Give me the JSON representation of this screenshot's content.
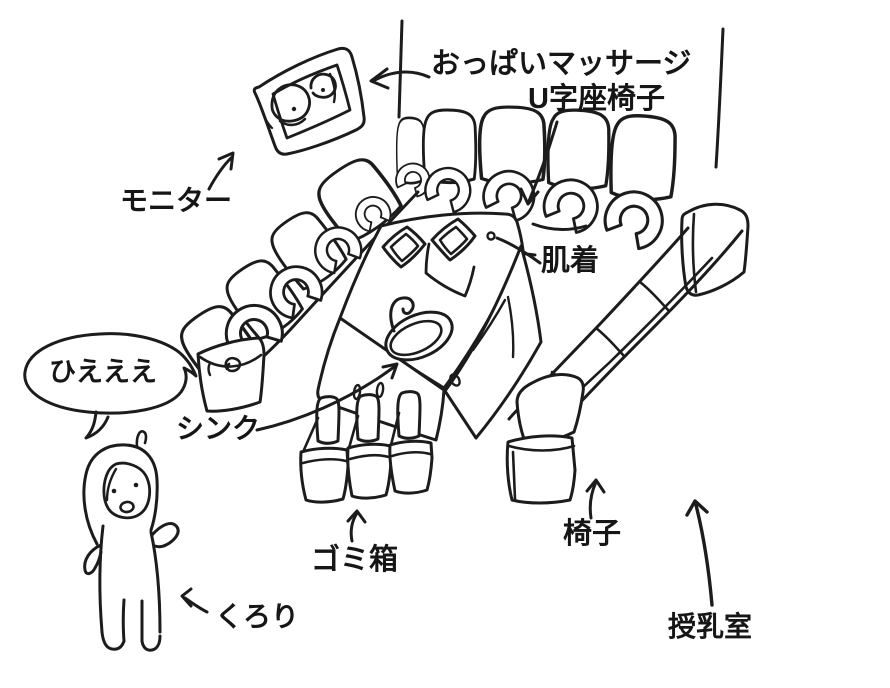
{
  "scene": {
    "labels": {
      "massage": "おっぱいマッサージ",
      "u_chair": "U字座椅子",
      "monitor": "モニター",
      "underwear": "肌着",
      "speech": "ひえええ",
      "sink": "シンク",
      "trash": "ゴミ箱",
      "chair": "椅子",
      "kurori": "くろり",
      "nursing_room": "授乳室"
    },
    "colors": {
      "ink": "#1c1c1c",
      "background": "#ffffff"
    }
  }
}
